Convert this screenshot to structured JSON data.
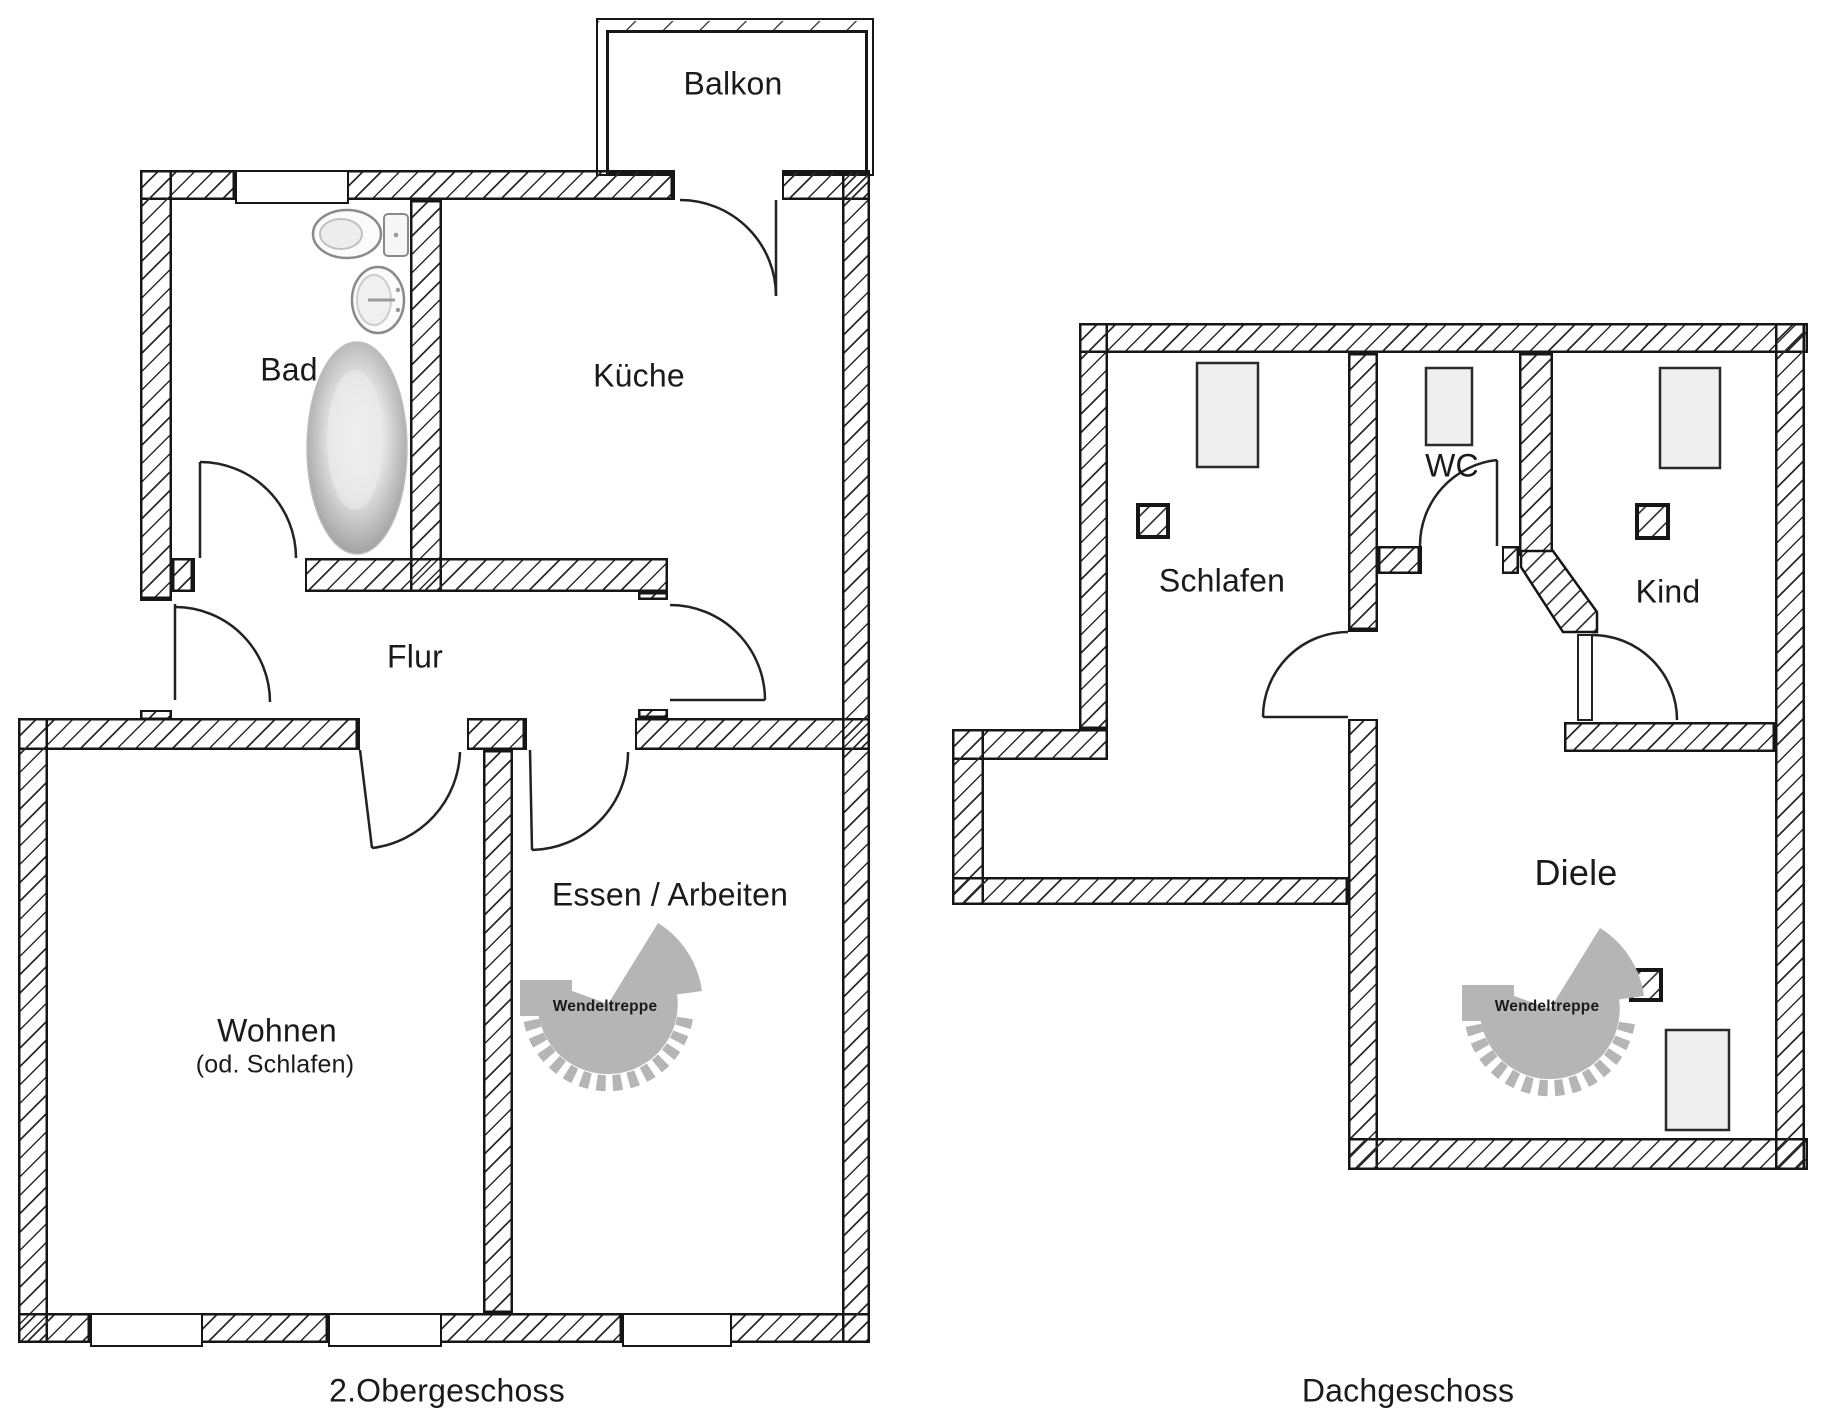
{
  "document": {
    "type": "floorplan-drawing",
    "language": "de"
  },
  "plans": [
    {
      "title": "2.Obergeschoss",
      "rooms": [
        {
          "label": "Balkon"
        },
        {
          "label": "Bad"
        },
        {
          "label": "Küche"
        },
        {
          "label": "Flur"
        },
        {
          "label": "Wohnen",
          "sublabel": "(od. Schlafen)"
        },
        {
          "label": "Essen / Arbeiten"
        }
      ],
      "stairs_label": "Wendeltreppe",
      "fixtures": [
        "toilet",
        "sink",
        "bathtub",
        "spiral-staircase"
      ]
    },
    {
      "title": "Dachgeschoss",
      "rooms": [
        {
          "label": "Schlafen"
        },
        {
          "label": "WC"
        },
        {
          "label": "Kind"
        },
        {
          "label": "Diele"
        }
      ],
      "stairs_label": "Wendeltreppe",
      "fixtures": [
        "roof-window",
        "roof-window",
        "roof-window",
        "chimney",
        "chimney",
        "chimney",
        "spiral-staircase",
        "skylight-panel"
      ]
    }
  ],
  "colors": {
    "line": "#161616",
    "hatch": "#2b2b2b",
    "stair_gray": "#b5b5b5",
    "window_fill": "#efefef",
    "fixture_gray": "#9a9a9a",
    "background": "#ffffff"
  }
}
